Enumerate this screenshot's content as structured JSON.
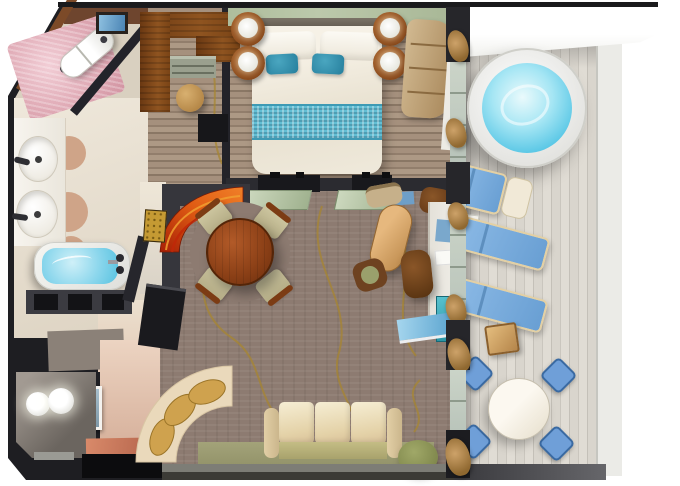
{
  "meta": {
    "title": "Cruise ship suite floor plan - 3D top-down rendering",
    "view": "top-down 3D render",
    "visible_text": "none"
  },
  "palette": {
    "bg": "#ffffff",
    "wall-dark": "#1e1e22",
    "wall-brown": "#6e452e",
    "wall-pink": "#d2a993",
    "bedroom-wall-green": "#bcc9ab",
    "carpet": "#8d7b71",
    "gold": "#a8862f",
    "closet-wood": "#6a3812",
    "closet-wood-light": "#8f5420",
    "marble-pink": "#e0abb6",
    "water-light": "#a6e6f4",
    "water": "#5cc8e6",
    "deck-light": "#d9d5cd",
    "deck-dark": "#c4c0b8",
    "lounger-blue": "#8cbae6",
    "lounger-blue-dark": "#699fd3",
    "chair-blue": "#6f9fd8",
    "table-wood": "#8a3f16",
    "coffee-wood": "#bd8a4c",
    "sofa-cream": "#e4d2a8",
    "sofa-olive": "#a8a26c",
    "cushion-gold": "#cfa24e",
    "banquette-orange": "#e05c14",
    "banquette-red": "#a82006",
    "curtain-tan": "#cda269",
    "glass-green": "#9fb18e",
    "accent-teal": "#257e9c",
    "runner-teal": "#62bed4",
    "skylight-blue": "#58a2ce"
  },
  "rooms": [
    {
      "id": "wc",
      "label": "Water closet with toilet and pink marble floor"
    },
    {
      "id": "bathroom",
      "label": "Bathroom with double sinks and bathtub"
    },
    {
      "id": "dressing-room",
      "label": "Walk-in closet with L-shaped wardrobe and stool"
    },
    {
      "id": "bedroom",
      "label": "Bedroom with double bed and nightstands"
    },
    {
      "id": "living-room",
      "label": "Living and dining room"
    },
    {
      "id": "entry",
      "label": "Entry vestibule with globe ceiling lights"
    },
    {
      "id": "balcony",
      "label": "Private balcony with hot tub and loungers"
    }
  ],
  "furniture": {
    "bedroom": [
      "double-bed",
      "white-pillows",
      "teal-accent-pillows",
      "teal-bed-runner",
      "nightstand-lamps",
      "curved-dresser"
    ],
    "bathroom": [
      "toilet",
      "double-sink-counter",
      "bathtub",
      "dark-vanity"
    ],
    "dressing_room": [
      "l-shaped-wardrobe",
      "drawer-unit",
      "round-stool",
      "safe"
    ],
    "living_room": [
      "round-dining-table",
      "dining-chairs",
      "curved-orange-banquette",
      "gold-dot-wall-art",
      "oval-coffee-table",
      "armchairs",
      "writing-desk",
      "desk-chair",
      "sofa",
      "curved-bench-with-gold-cushions",
      "console-cabinet",
      "green-pouf"
    ],
    "entry": [
      "globe-ceiling-lights",
      "framed-picture"
    ],
    "balcony": [
      "round-hot-tub",
      "sun-loungers",
      "ottoman",
      "side-table",
      "wood-stool",
      "round-dining-table",
      "blue-dining-chairs"
    ]
  },
  "counts": {
    "sun_loungers": 3,
    "balcony_dining_chairs": 4,
    "dining_chairs": 4,
    "sinks": 2,
    "entry_lights": 2,
    "gold_cushions": 3,
    "sofa_cushions": 3,
    "nightstands": 2
  }
}
